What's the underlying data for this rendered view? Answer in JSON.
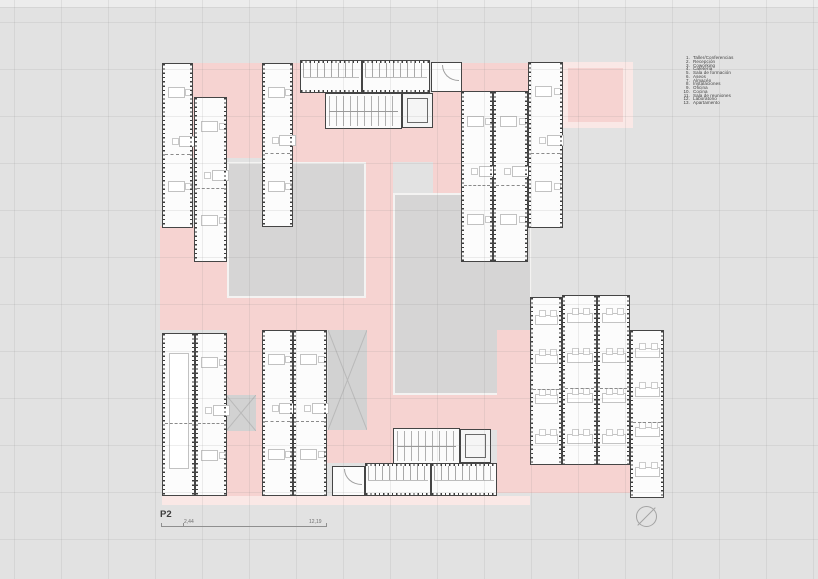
{
  "page": {
    "background": "#e2e2e2",
    "grid_offset": [
      14,
      8
    ],
    "grid_step": 47
  },
  "plan": {
    "label": "P2",
    "scale": {
      "left_value": "2,44",
      "right_value": "12,19"
    },
    "colors": {
      "circulation_pink": "#f6d3d1",
      "terrace_light_pink": "#fae8e6",
      "courtyard_gray": "#d6d5d5",
      "module_wall": "#454545",
      "module_fill": "#fcfcfc"
    },
    "elements": [
      {
        "t": "plight",
        "name": "terrace-outer",
        "x": 563,
        "y": 62,
        "w": 70,
        "h": 66
      },
      {
        "t": "pink",
        "name": "terrace-inner",
        "x": 568,
        "y": 68,
        "w": 55,
        "h": 54
      },
      {
        "t": "pink",
        "name": "circulation-topleft",
        "x": 193,
        "y": 63,
        "w": 69,
        "h": 95
      },
      {
        "t": "pink",
        "name": "circulation-left",
        "x": 160,
        "y": 226,
        "w": 67,
        "h": 104
      },
      {
        "t": "pink",
        "name": "circulation-center-top",
        "x": 293,
        "y": 63,
        "w": 32,
        "h": 65
      },
      {
        "t": "pink",
        "name": "circulation-under-stair",
        "x": 293,
        "y": 128,
        "w": 140,
        "h": 34
      },
      {
        "t": "pink",
        "name": "circulation-center-vertical",
        "x": 362,
        "y": 162,
        "w": 31,
        "h": 136
      },
      {
        "t": "pink",
        "name": "circulation-topright-band",
        "x": 433,
        "y": 63,
        "w": 130,
        "h": 65
      },
      {
        "t": "pink",
        "name": "circulation-right-vertical",
        "x": 433,
        "y": 128,
        "w": 28,
        "h": 170
      },
      {
        "t": "court",
        "name": "courtyard-west",
        "x": 227,
        "y": 162,
        "w": 139,
        "h": 136
      },
      {
        "t": "court",
        "name": "courtyard-east",
        "x": 393,
        "y": 193,
        "w": 139,
        "h": 202
      },
      {
        "t": "pink",
        "name": "circulation-mid-band",
        "x": 227,
        "y": 298,
        "w": 140,
        "h": 32
      },
      {
        "t": "pink",
        "name": "circulation-bottomleft-vertical",
        "x": 227,
        "y": 330,
        "w": 35,
        "h": 166
      },
      {
        "t": "pink",
        "name": "circulation-center-lower",
        "x": 367,
        "y": 298,
        "w": 26,
        "h": 132
      },
      {
        "t": "pink",
        "name": "circulation-bottomright-vertical",
        "x": 497,
        "y": 330,
        "w": 35,
        "h": 133
      },
      {
        "t": "pink",
        "name": "circulation-above-stair2",
        "x": 393,
        "y": 395,
        "w": 104,
        "h": 35
      },
      {
        "t": "pink",
        "name": "circulation-bottom-connector",
        "x": 327,
        "y": 430,
        "w": 66,
        "h": 33
      },
      {
        "t": "pink",
        "name": "circulation-bottom-band",
        "x": 497,
        "y": 463,
        "w": 133,
        "h": 30
      },
      {
        "t": "plight",
        "name": "terrace-bottom-strip",
        "x": 162,
        "y": 496,
        "w": 368,
        "h": 9
      },
      {
        "t": "void",
        "name": "void-small",
        "x": 226,
        "y": 395,
        "w": 30,
        "h": 36
      },
      {
        "t": "void",
        "name": "void-large",
        "x": 328,
        "y": 330,
        "w": 39,
        "h": 100
      },
      {
        "t": "mod",
        "name": "module-nw-1",
        "x": 162,
        "y": 63,
        "w": 31,
        "h": 165,
        "f": "desks"
      },
      {
        "t": "mod",
        "name": "module-nw-2",
        "x": 194,
        "y": 97,
        "w": 33,
        "h": 165,
        "f": "desks"
      },
      {
        "t": "mod",
        "name": "module-nw-3",
        "x": 262,
        "y": 63,
        "w": 31,
        "h": 164,
        "f": "desks"
      },
      {
        "t": "modh",
        "name": "module-wc-north-1",
        "x": 300,
        "y": 60,
        "w": 62,
        "h": 33,
        "f": "wc"
      },
      {
        "t": "modh",
        "name": "module-wc-north-2",
        "x": 362,
        "y": 60,
        "w": 68,
        "h": 33,
        "f": "wc"
      },
      {
        "t": "room",
        "name": "room-north",
        "x": 431,
        "y": 62,
        "w": 31,
        "h": 30
      },
      {
        "t": "stair",
        "name": "stair-north",
        "x": 325,
        "y": 93,
        "w": 77,
        "h": 36
      },
      {
        "t": "lift",
        "name": "lift-north",
        "x": 402,
        "y": 93,
        "w": 31,
        "h": 35
      },
      {
        "t": "mod",
        "name": "module-ne-1",
        "x": 461,
        "y": 91,
        "w": 32,
        "h": 171,
        "f": "desks"
      },
      {
        "t": "mod",
        "name": "module-ne-2",
        "x": 493,
        "y": 91,
        "w": 35,
        "h": 171,
        "f": "desks"
      },
      {
        "t": "mod",
        "name": "module-ne-3",
        "x": 528,
        "y": 62,
        "w": 35,
        "h": 166,
        "f": "desks"
      },
      {
        "t": "mod",
        "name": "module-sw-conference",
        "x": 162,
        "y": 333,
        "w": 33,
        "h": 163,
        "f": "conf"
      },
      {
        "t": "mod",
        "name": "module-sw-2",
        "x": 195,
        "y": 333,
        "w": 32,
        "h": 163,
        "f": "desks"
      },
      {
        "t": "mod",
        "name": "module-sw-3",
        "x": 262,
        "y": 330,
        "w": 31,
        "h": 166,
        "f": "desks"
      },
      {
        "t": "mod",
        "name": "module-sw-4",
        "x": 293,
        "y": 330,
        "w": 34,
        "h": 166,
        "f": "desks"
      },
      {
        "t": "stair",
        "name": "stair-south",
        "x": 393,
        "y": 428,
        "w": 67,
        "h": 36
      },
      {
        "t": "lift",
        "name": "lift-south",
        "x": 460,
        "y": 429,
        "w": 31,
        "h": 34
      },
      {
        "t": "modh",
        "name": "module-wc-south-1",
        "x": 365,
        "y": 463,
        "w": 66,
        "h": 33,
        "f": "wc"
      },
      {
        "t": "modh",
        "name": "module-wc-south-2",
        "x": 431,
        "y": 463,
        "w": 66,
        "h": 33,
        "f": "wc"
      },
      {
        "t": "room",
        "name": "room-south",
        "x": 332,
        "y": 466,
        "w": 33,
        "h": 30
      },
      {
        "t": "mod",
        "name": "module-se-1",
        "x": 530,
        "y": 297,
        "w": 32,
        "h": 168,
        "f": "class"
      },
      {
        "t": "mod",
        "name": "module-se-2",
        "x": 562,
        "y": 295,
        "w": 35,
        "h": 170,
        "f": "class"
      },
      {
        "t": "mod",
        "name": "module-se-3",
        "x": 597,
        "y": 295,
        "w": 33,
        "h": 170,
        "f": "class"
      },
      {
        "t": "mod",
        "name": "module-se-4",
        "x": 630,
        "y": 330,
        "w": 34,
        "h": 168,
        "f": "class"
      }
    ]
  },
  "legend": {
    "items": [
      {
        "n": "1.",
        "label": "Taller/Conferencias"
      },
      {
        "n": "2.",
        "label": "Recepción"
      },
      {
        "n": "3.",
        "label": "Coworking"
      },
      {
        "n": "4.",
        "label": "Cafetería"
      },
      {
        "n": "5.",
        "label": "Sala de formación"
      },
      {
        "n": "6.",
        "label": "Aseos"
      },
      {
        "n": "7.",
        "label": "Almacén"
      },
      {
        "n": "8.",
        "label": "Instalaciones"
      },
      {
        "n": "9.",
        "label": "Oficina"
      },
      {
        "n": "10.",
        "label": "Cocina"
      },
      {
        "n": "11.",
        "label": "Sala de reuniones"
      },
      {
        "n": "12.",
        "label": "Laboratorio"
      },
      {
        "n": "13.",
        "label": "Apartamento"
      }
    ]
  }
}
